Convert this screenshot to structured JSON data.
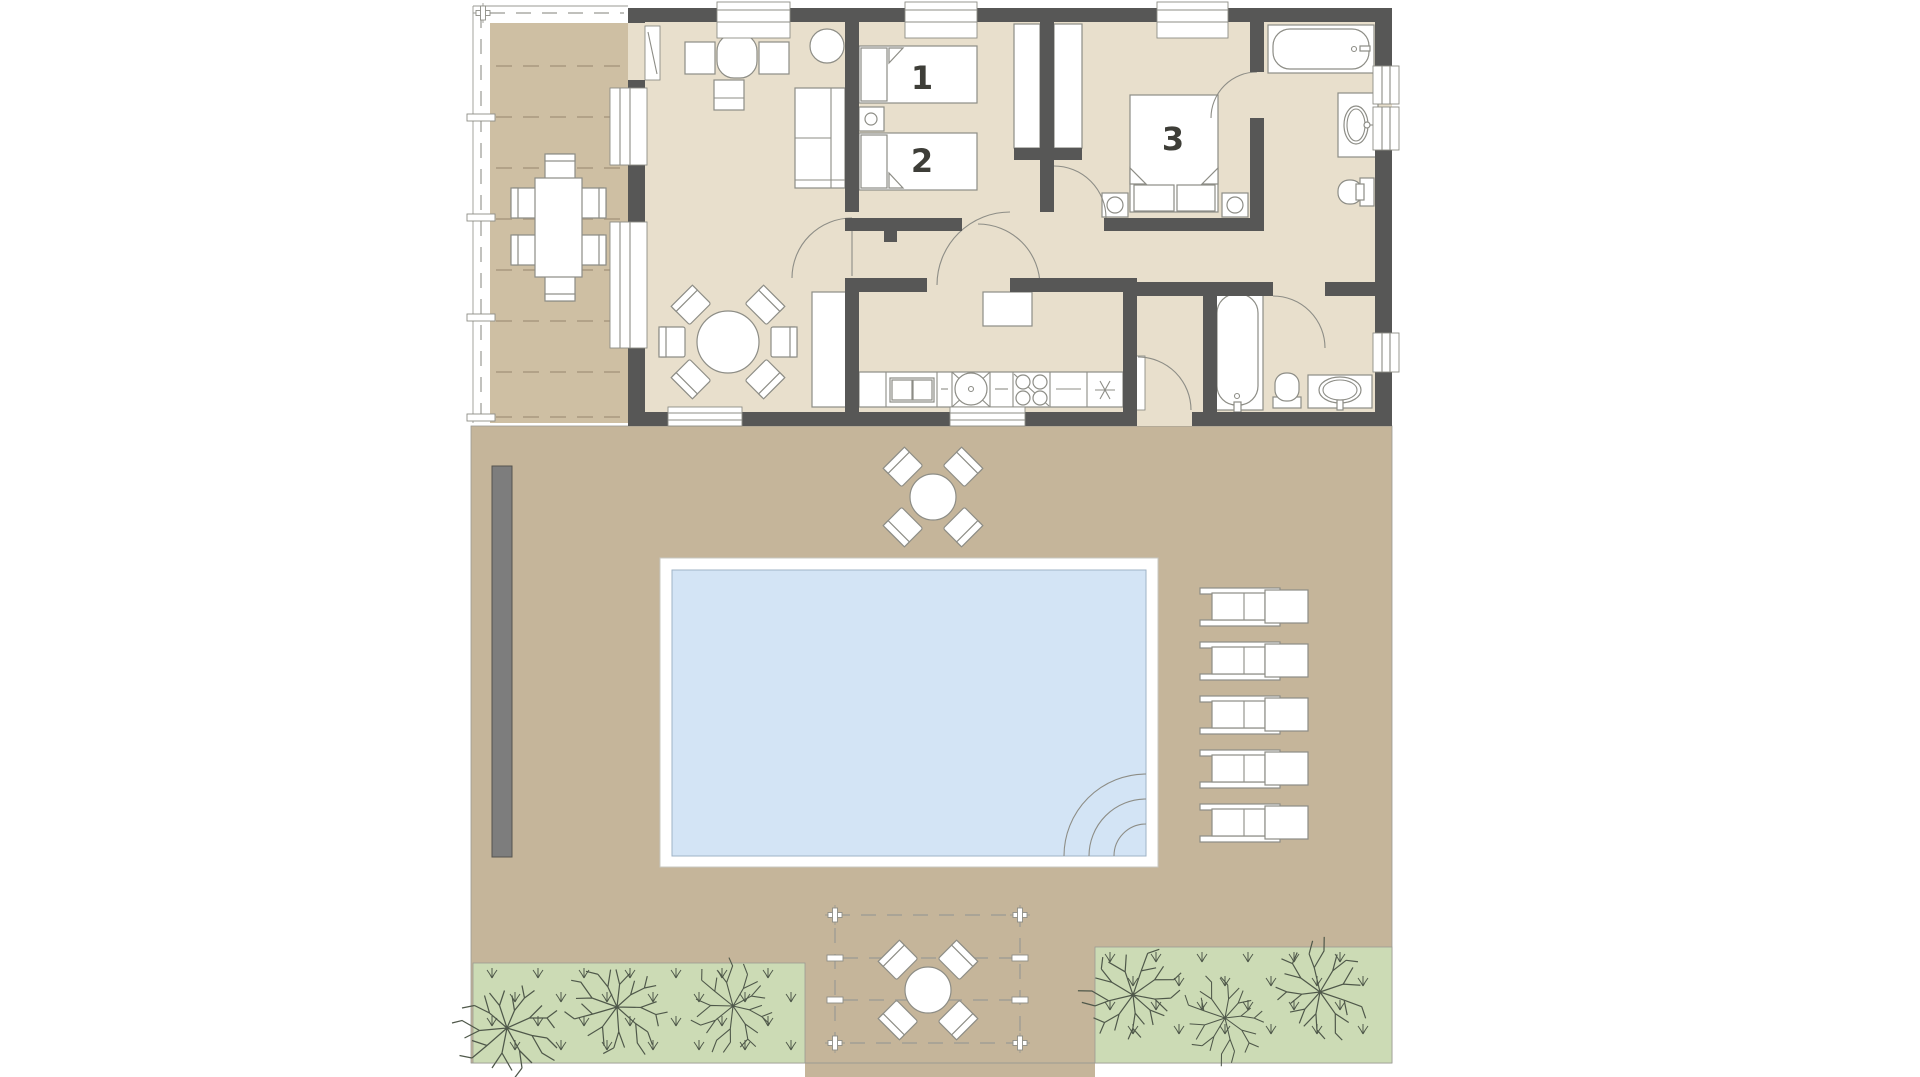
{
  "page": {
    "kind": "architectural floor plan of a 3-room house with pool garden",
    "visible_text": [
      "1",
      "2",
      "3"
    ]
  },
  "rooms": [
    {
      "id": "bedroom-1",
      "label": "1"
    },
    {
      "id": "bedroom-2",
      "label": "2"
    },
    {
      "id": "bedroom-3",
      "label": "3"
    }
  ],
  "colors": {
    "background": "#ffffff",
    "wall": "#575756",
    "floor": "#e8dfcc",
    "deck": "#cebfa3",
    "deck_line": "#b2a288",
    "garden": "#c5b59a",
    "garden_wall": "#7d7d7d",
    "grass": "#ccdbb5",
    "pool_water": "#d3e4f5",
    "pool_water_stroke": "#9fb3c6",
    "furniture_fill": "#ffffff",
    "furniture_stroke": "#8d8d86",
    "line": "#9a9a93",
    "vegetation": "#4f584a",
    "label": "#3e3e38"
  },
  "objects": {
    "deck": [
      "dining-table-6-chairs",
      "pergola-dashed-rafters"
    ],
    "living_room": [
      "desk-with-chairs",
      "round-side-table",
      "sofa",
      "round-dining-table-6-chairs",
      "tall-cabinet"
    ],
    "bedroom_1_2": [
      "single-bed-1",
      "single-bed-2",
      "nightstand-with-lamp",
      "wardrobe-left",
      "wardrobe-right"
    ],
    "bedroom_3": [
      "double-bed",
      "nightstand-left",
      "nightstand-right"
    ],
    "bathroom_top": [
      "bathtub",
      "washbasin",
      "toilet"
    ],
    "bathroom_bottom": [
      "bathtub",
      "toilet",
      "washbasin"
    ],
    "kitchen": [
      "island-counter",
      "dishwasher",
      "round-sink",
      "stove-4-burners",
      "refrigerator"
    ],
    "garden": [
      "patio-table-4-chairs",
      "swimming-pool-with-corner-steps",
      "sun-loungers-5",
      "pergola-table-4-chairs",
      "garden-wall-bar",
      "lawn-left-3-trees",
      "lawn-right-3-trees"
    ]
  }
}
